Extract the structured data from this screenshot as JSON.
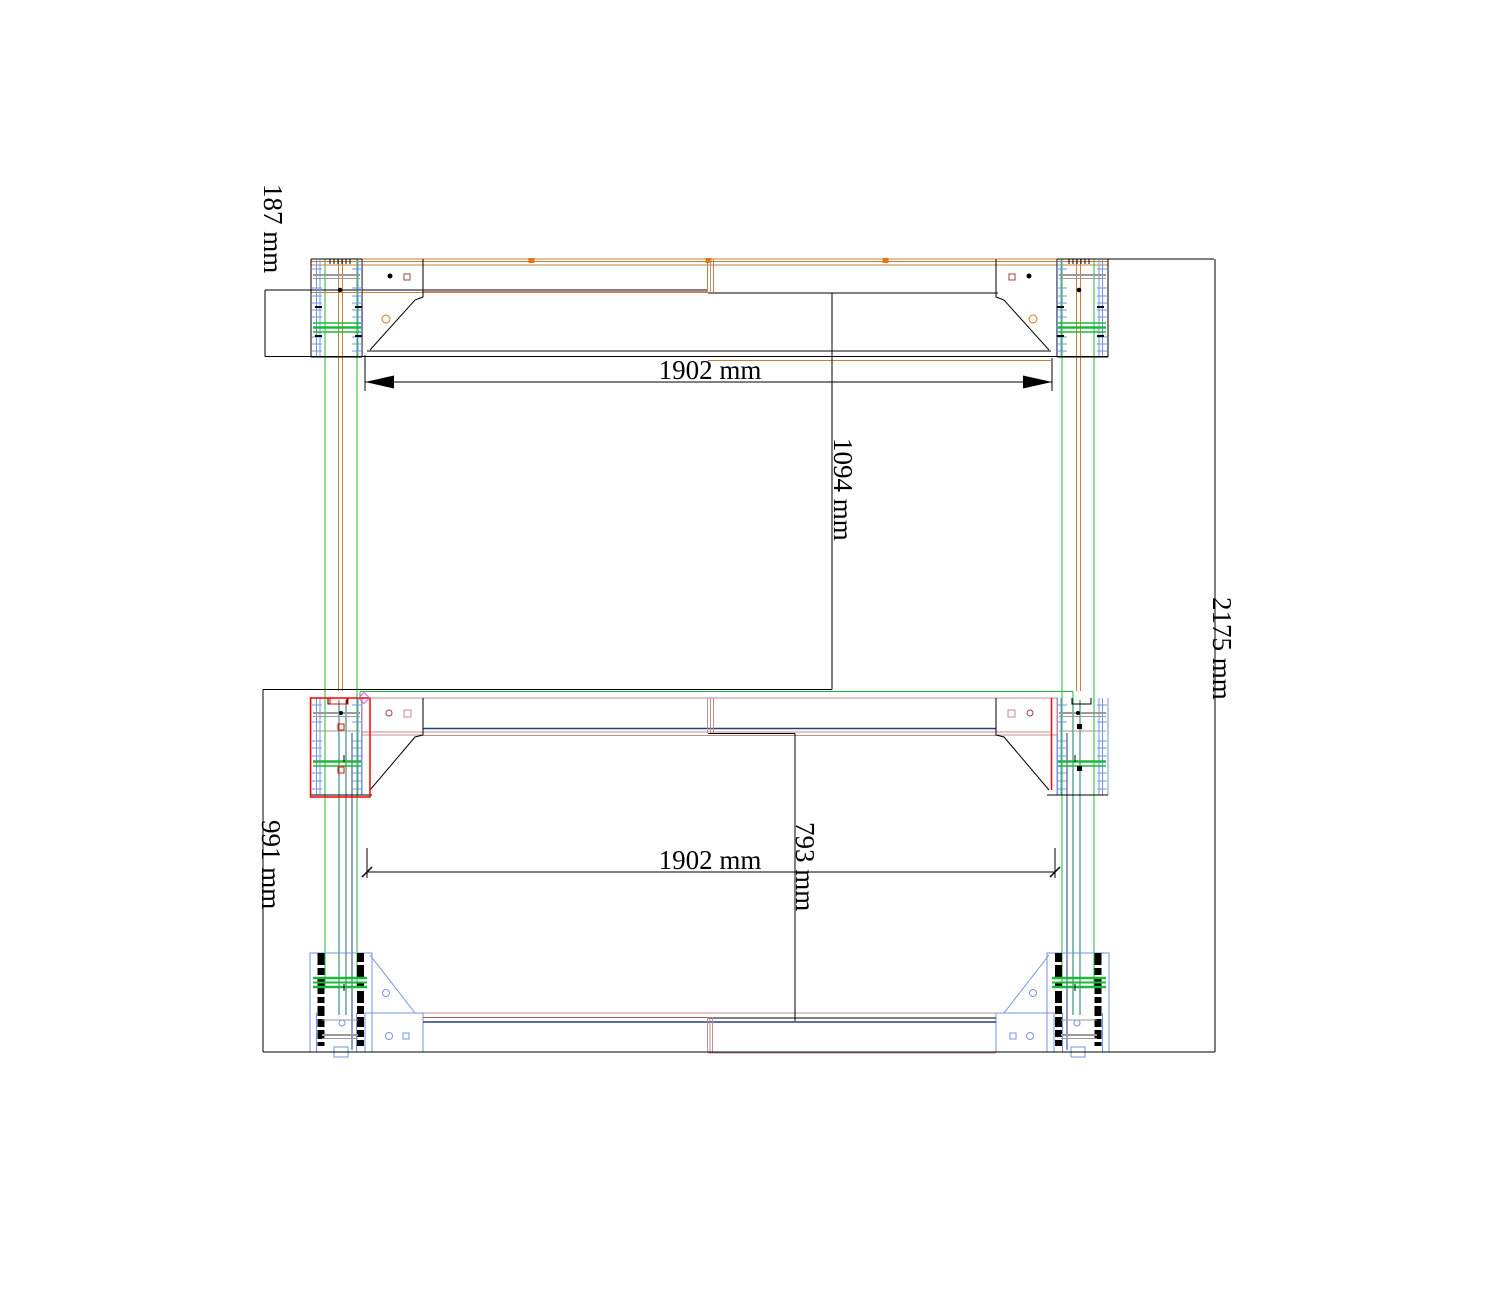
{
  "drawing": {
    "kind": "CAD dimensioned frame drawing",
    "units": "mm"
  },
  "dimensions": {
    "d187_label": "187 mm",
    "d1902_top_label": "1902 mm",
    "d1094_label": "1094 mm",
    "d2175_label": "2175 mm",
    "d991_label": "991 mm",
    "d1902_bottom_label": "1902 mm",
    "d793_label": "793 mm"
  },
  "colors": {
    "line": "#000000",
    "tan": "#c5803c",
    "orange": "#e07818",
    "rose": "#c18e8e",
    "darkred": "#9a4444",
    "blue": "#7295e2",
    "paleblue": "#aebfe8",
    "navy": "#24407e",
    "green": "#1cb83a",
    "teal": "#157a64",
    "gray": "#9a9a9a",
    "red": "#ff0000",
    "magenta": "#e158e1",
    "brownred": "#b05555",
    "bg": "#ffffff"
  }
}
